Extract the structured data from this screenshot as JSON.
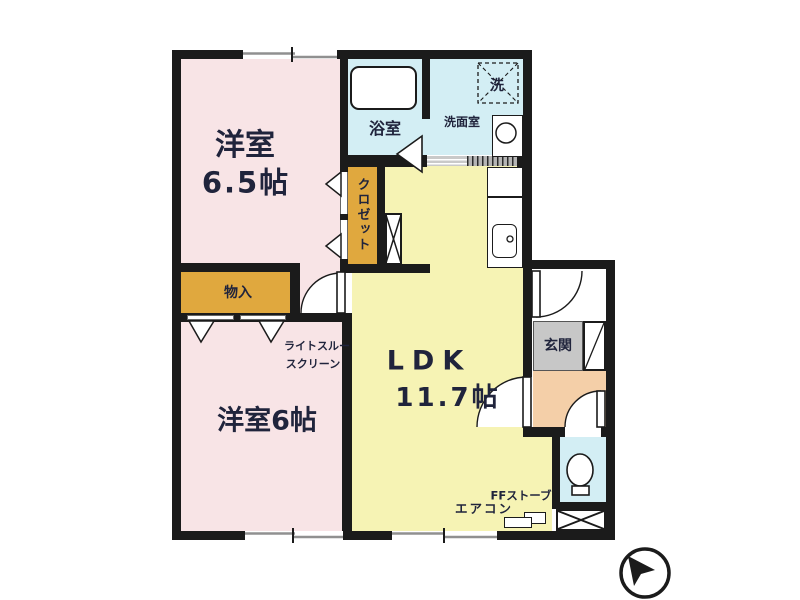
{
  "plan": {
    "rooms": {
      "western65": {
        "name": "洋室",
        "size": "6.5帖"
      },
      "western6": {
        "name": "洋室6帖"
      },
      "ldk": {
        "name": "LDK",
        "size": "11.7帖"
      },
      "bathroom": {
        "name": "浴室"
      },
      "washroom": {
        "name": "洗面室"
      },
      "washer": {
        "name": "洗"
      },
      "closet": {
        "name": "クロゼット"
      },
      "storage": {
        "name": "物入"
      },
      "entrance": {
        "name": "玄関"
      }
    },
    "annotations": {
      "screen1": "ライトスルー",
      "screen2": "スクリーン",
      "ffstove": "FFストーブ",
      "aircon": "エアコン"
    },
    "colors": {
      "room_pink": "#f8e4e6",
      "ldk_yellow": "#f6f3b4",
      "wet_cyan": "#d3eef4",
      "storage_orange": "#e0a83e",
      "hall_peach": "#f4cfa8",
      "entrance_gray": "#c7c7c7",
      "wall": "#1b1b1b",
      "window_gray": "#909090",
      "text": "#20243c"
    }
  }
}
